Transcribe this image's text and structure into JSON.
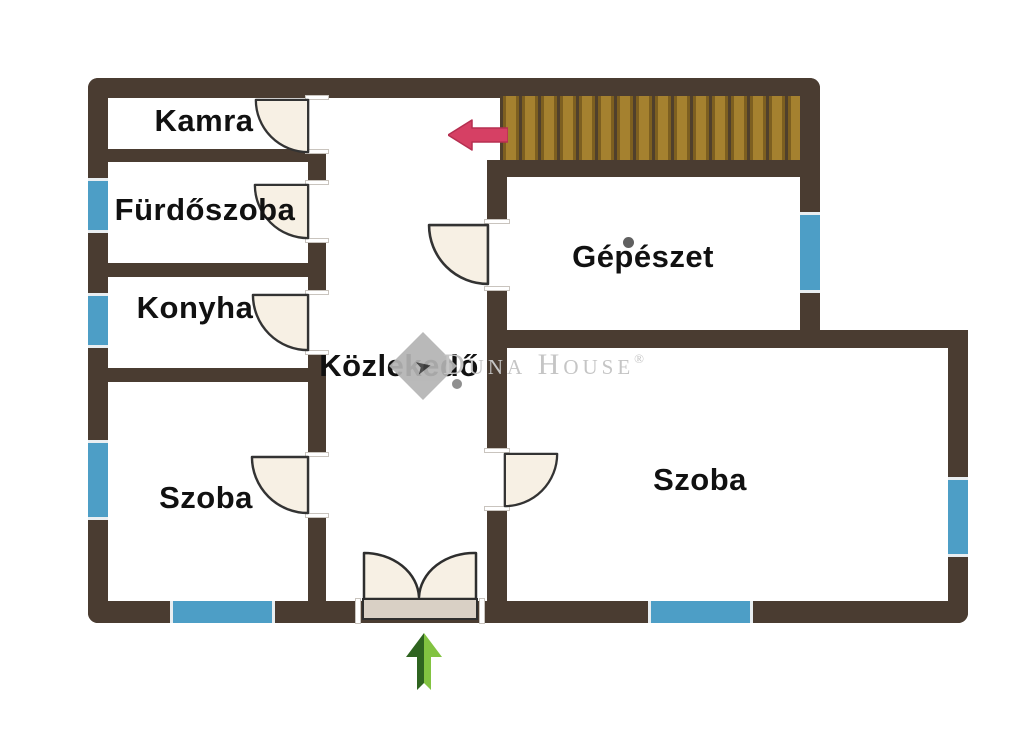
{
  "document": {
    "type": "floor-plan",
    "language": "hu"
  },
  "rooms": [
    {
      "label": "Kamra"
    },
    {
      "label": "Fürdőszoba"
    },
    {
      "label": "Konyha"
    },
    {
      "label": "Szoba"
    },
    {
      "label": "Közlekedő"
    },
    {
      "label": "Gépészet"
    },
    {
      "label": "Szoba"
    }
  ],
  "watermark": {
    "brand": "Duna House",
    "registered": "®"
  },
  "icons": {
    "stairs_direction_arrow": "left-arrow-red",
    "entrance_arrow": "up-arrow-green",
    "watermark_logo": "duna-house-diamond",
    "stairs": "wood-stair-treads"
  },
  "colors": {
    "wall": "#4a3c31",
    "window": "#4d9ec6",
    "door": "#f7f0e4",
    "stairs_wood": "#a5812f",
    "arrow_red": "#d64064",
    "arrow_green_dark": "#2f6420",
    "arrow_green_light": "#82c341",
    "watermark": "#c5c5c5",
    "background": "#ffffff",
    "label_text": "#111111"
  }
}
